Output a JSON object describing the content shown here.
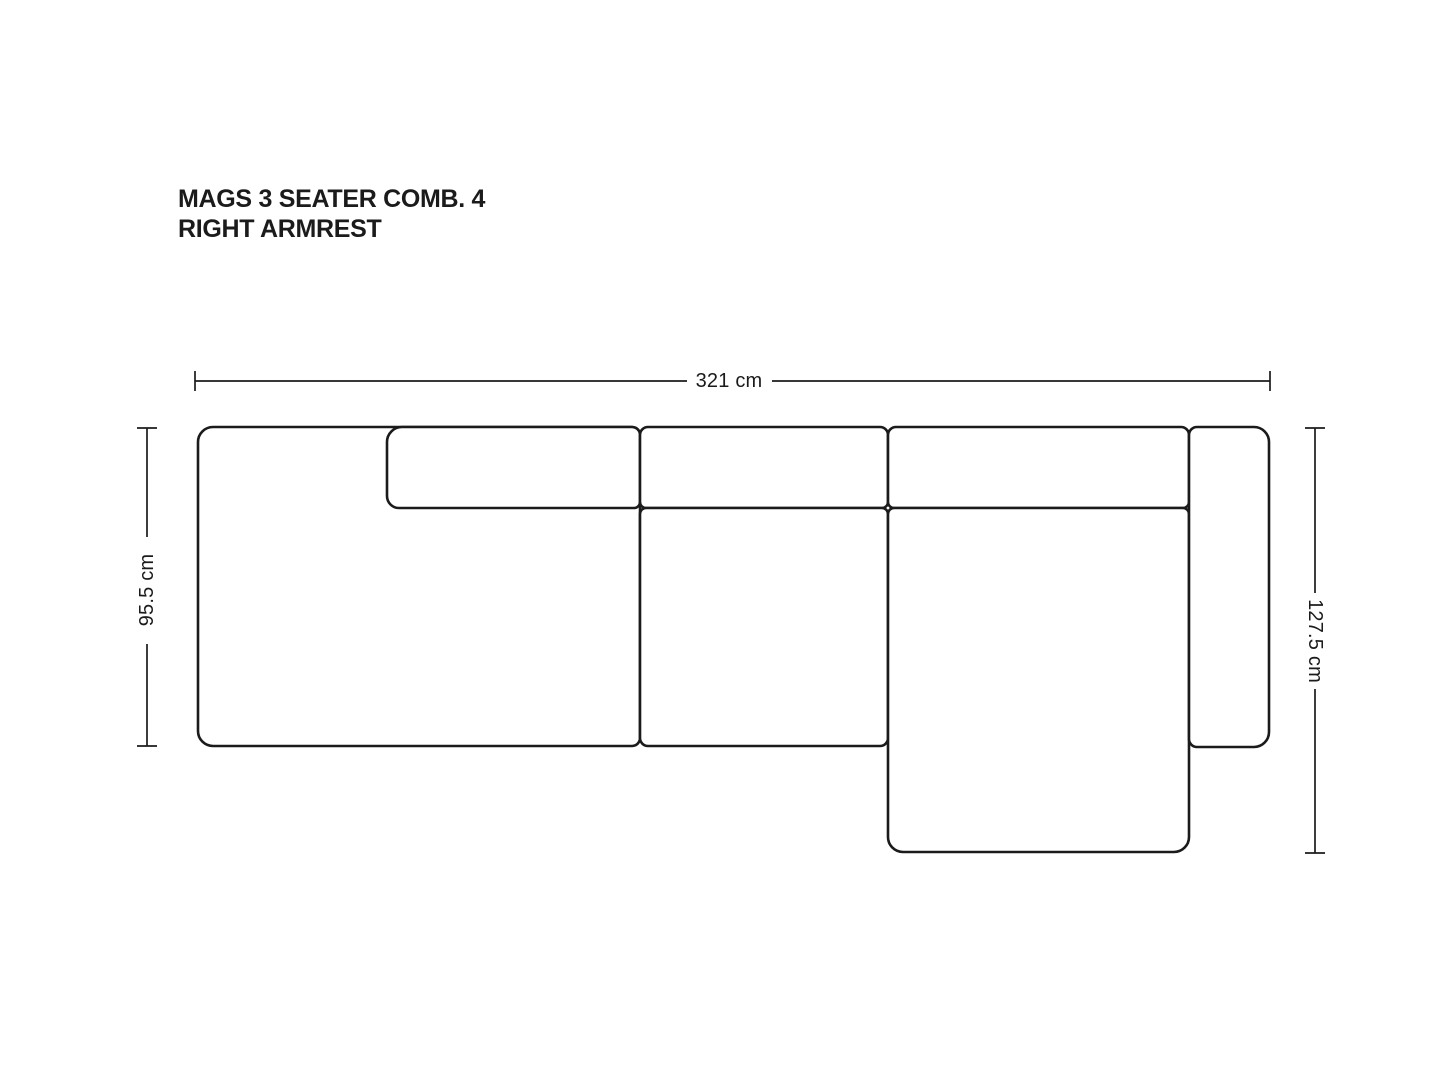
{
  "title": {
    "line1": "MAGS 3 SEATER COMB. 4",
    "line2": "RIGHT ARMREST"
  },
  "diagram": {
    "ink_color": "#1b1b1b",
    "background_color": "#ffffff",
    "dimensions": {
      "width": {
        "label": "321 cm",
        "value": 321,
        "unit": "cm"
      },
      "left_depth": {
        "label": "95.5 cm",
        "value": 95.5,
        "unit": "cm"
      },
      "right_depth": {
        "label": "127.5 cm",
        "value": 127.5,
        "unit": "cm"
      }
    }
  }
}
